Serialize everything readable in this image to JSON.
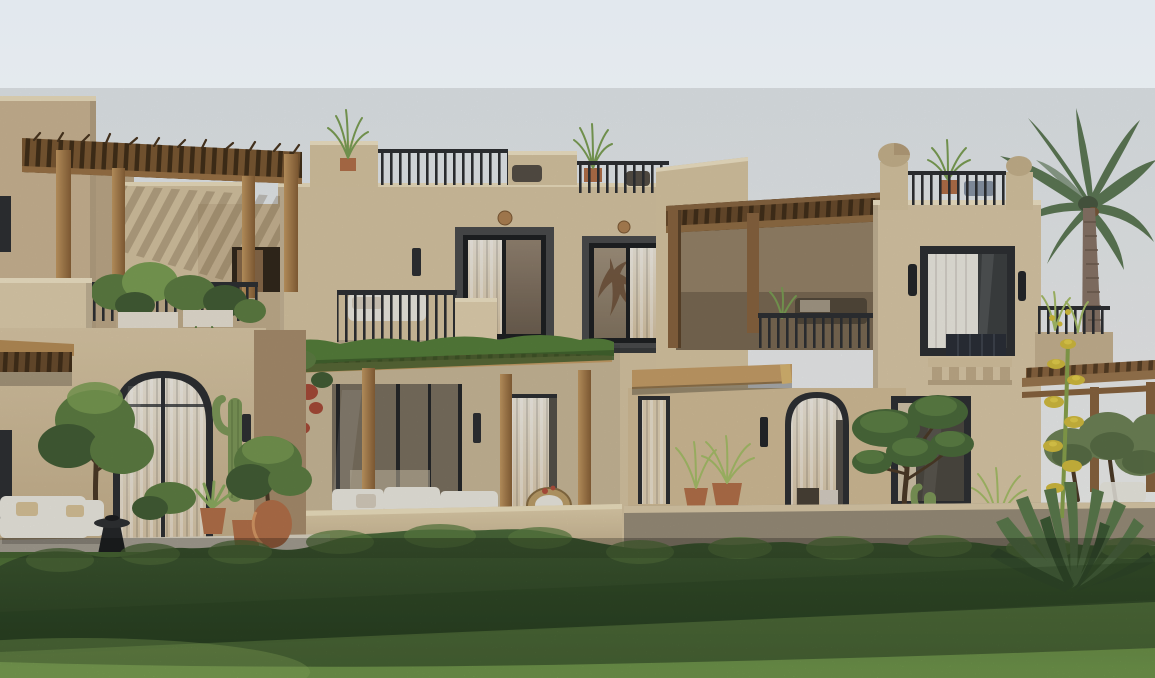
{
  "meta": {
    "type": "architectural-exterior-render",
    "setting": "Row of two-story sandstone villas with roof terraces, timber pergolas, arched glass doors, a palm tree and a sunlit garden lawn",
    "time_of_day": "daytime",
    "text_present": false
  },
  "palette": {
    "sky_top": "#e2e8ee",
    "sky_bottom": "#f6f5f1",
    "wall_lit": "#d8c6a4",
    "wall_mid": "#c9b493",
    "wall_shade": "#b09878",
    "parapet_highlight": "#eee0c0",
    "frame_dark": "#2e3134",
    "window_stone": "#4b4d4e",
    "glass_dark": "#45453f",
    "curtain_beige": "#e2d3b6",
    "curtain_white": "#efece4",
    "wood_light": "#c79f68",
    "wood_mid": "#a97f52",
    "wood_dark": "#6e4f2e",
    "terracotta": "#b5714a",
    "foliage_light": "#7da055",
    "foliage_mid": "#5f7f44",
    "foliage_dark": "#445f36",
    "palm_green": "#5f7a57",
    "palm_trunk": "#8a7668",
    "grass_far": "#5d8542",
    "grass_near": "#82b158",
    "hedge_light": "#4b6a3b",
    "hedge_dark": "#2f4a27",
    "sofa_white": "#edebe2",
    "patio": "#dcd5c4"
  },
  "scene": {
    "buildings": [
      {
        "id": "left-villa",
        "features": [
          "rooftop timber pergola with rustic slats",
          "balcony with planter boxes and shrubs",
          "arched glass door with sheer curtains",
          "white outdoor sofa set",
          "black pedestal side table"
        ]
      },
      {
        "id": "middle-villa",
        "features": [
          "roof terrace railings with potted grasses and chairs",
          "two charcoal-framed picture windows",
          "round timber wall medallions",
          "vine-covered patio pergola with bougainvillea",
          "white modular outdoor sofa",
          "rattan armchair and coffee table",
          "low stucco seat wall"
        ]
      },
      {
        "id": "right-villa",
        "features": [
          "corner piers with dome finials",
          "roof terrace railing with plants and lounger",
          "dark timber balcony pergola",
          "curtained window flanked by twin sconces",
          "corbelled cornice detail",
          "cantilevered timber entrance canopy",
          "arched entry with curtain"
        ]
      }
    ],
    "landscape": [
      "coconut palm",
      "cloud-pruned topiary tree",
      "olive trees",
      "saguaro cactus",
      "agave with tall yellow flower stalk",
      "fountain grass in terracotta urns",
      "terracotta pots",
      "clipped hedge row",
      "sunlit lawn with diagonal light"
    ]
  }
}
